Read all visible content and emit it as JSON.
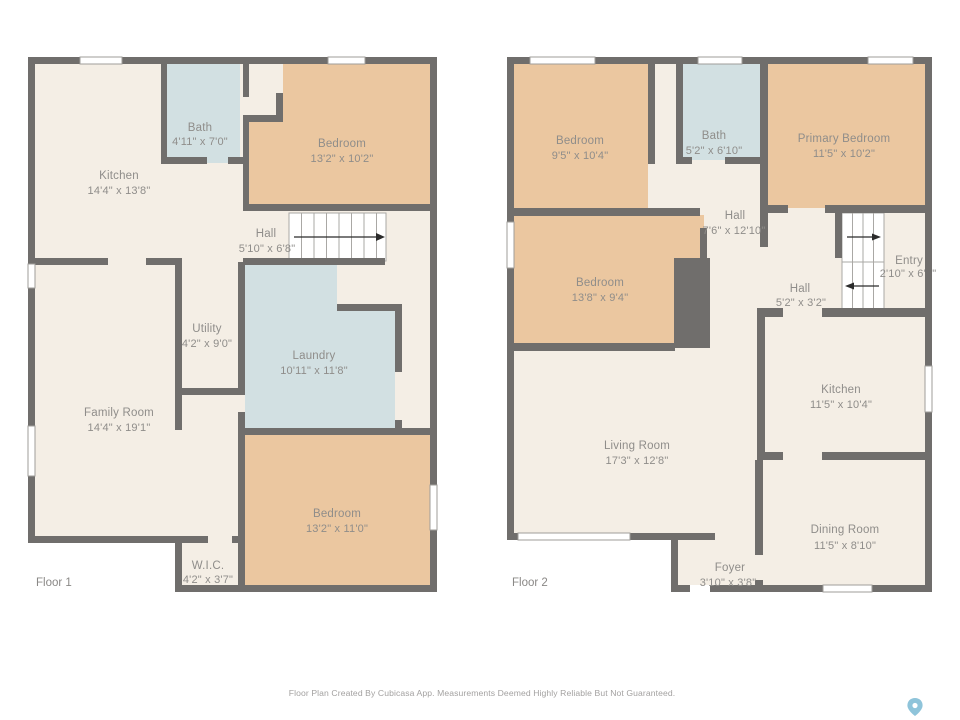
{
  "title": "Floor Plan",
  "colors": {
    "wall": "#706e6c",
    "room_default": "#f4eee5",
    "room_bedroom": "#ebc7a0",
    "room_wet": "#d2e0e2",
    "pin": "#8fc4da"
  },
  "floors": [
    {
      "label": "Floor 1",
      "rooms": [
        {
          "name": "Kitchen",
          "dims": "14'4\" x 13'8\""
        },
        {
          "name": "Bath",
          "dims": "4'11\" x 7'0\""
        },
        {
          "name": "Bedroom",
          "dims": "13'2\" x 10'2\""
        },
        {
          "name": "Hall",
          "dims": "5'10\" x 6'8\""
        },
        {
          "name": "Utility",
          "dims": "4'2\" x 9'0\""
        },
        {
          "name": "Laundry",
          "dims": "10'11\" x 11'8\""
        },
        {
          "name": "Family Room",
          "dims": "14'4\" x 19'1\""
        },
        {
          "name": "Bedroom",
          "dims": "13'2\" x 11'0\""
        },
        {
          "name": "W.I.C.",
          "dims": "4'2\" x 3'7\""
        }
      ]
    },
    {
      "label": "Floor 2",
      "rooms": [
        {
          "name": "Bedroom",
          "dims": "9'5\" x 10'4\""
        },
        {
          "name": "Bath",
          "dims": "5'2\" x 6'10\""
        },
        {
          "name": "Primary Bedroom",
          "dims": "11'5\" x 10'2\""
        },
        {
          "name": "Hall",
          "dims": "7'6\" x 12'10\""
        },
        {
          "name": "Bedroom",
          "dims": "13'8\" x 9'4\""
        },
        {
          "name": "Entry",
          "dims": "2'10\" x 6'9\""
        },
        {
          "name": "Hall",
          "dims": "5'2\" x 3'2\""
        },
        {
          "name": "Kitchen",
          "dims": "11'5\" x 10'4\""
        },
        {
          "name": "Living Room",
          "dims": "17'3\" x 12'8\""
        },
        {
          "name": "Dining Room",
          "dims": "11'5\" x 8'10\""
        },
        {
          "name": "Foyer",
          "dims": "3'10\" x 3'8\""
        }
      ]
    }
  ],
  "footer": {
    "disclaimer": "Floor Plan Created By Cubicasa App. Measurements Deemed Highly Reliable But Not Guaranteed."
  }
}
